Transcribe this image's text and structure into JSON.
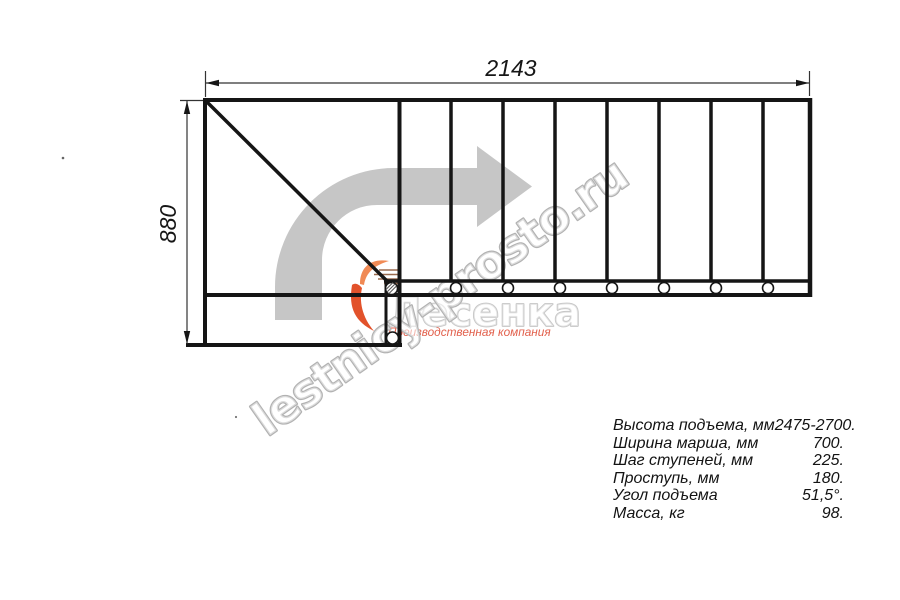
{
  "dimensions": {
    "width_mm": "2143",
    "height_mm": "880"
  },
  "watermark": {
    "site": "lestnicy-prosto.ru",
    "brand": "Лесенка",
    "subtitle": "Производственная компания"
  },
  "specs": {
    "rows": [
      {
        "label": "Высота подъема, мм",
        "value": "2475-2700."
      },
      {
        "label": "Ширина марша, мм",
        "value": "700."
      },
      {
        "label": "Шаг ступеней, мм",
        "value": "225."
      },
      {
        "label": "Проступь, мм",
        "value": "180."
      },
      {
        "label": "Угол подъема",
        "value": "51,5°."
      },
      {
        "label": "Масса, кг",
        "value": "98."
      }
    ]
  },
  "colors": {
    "drawing_line": "#151515",
    "dimension_line": "#333333",
    "arrow_gray": "#c6c6c6",
    "watermark_gray": "#b2b2b2",
    "logo_orange": "#ED6A3C",
    "logo_red": "#E2604C"
  }
}
